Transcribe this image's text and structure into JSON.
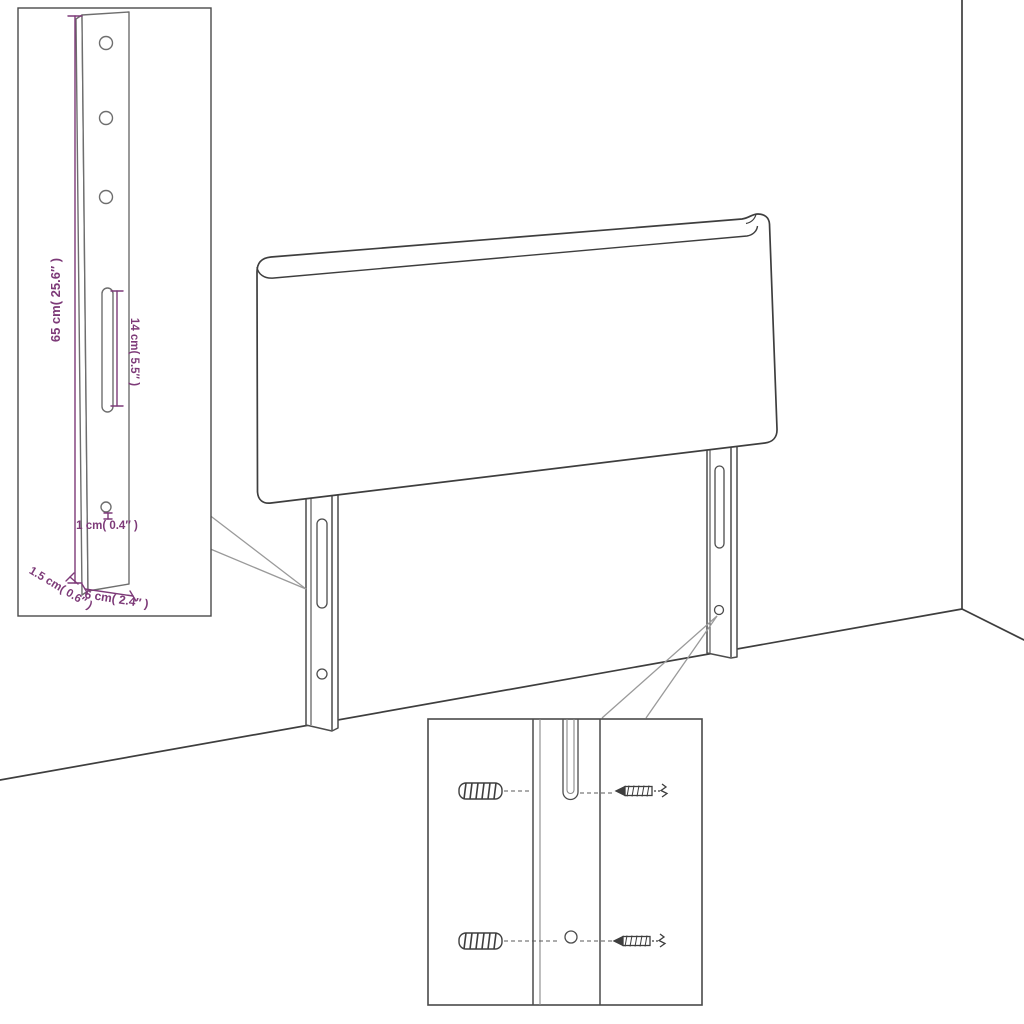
{
  "canvas": {
    "width": 1024,
    "height": 1024,
    "background": "#ffffff"
  },
  "palette": {
    "line": "#3e3e3e",
    "part_line": "#4c4c4c",
    "leader_line": "#9a9a9a",
    "annotation": "#7d3a78",
    "inset_border": "#4a4a4a",
    "fill": "#ffffff"
  },
  "scene": {
    "subject": "Headboard with two slotted wall-mount legs shown in a room corner, with a leg-dimension inset and a mounting-hardware inset",
    "insets": {
      "leg_dimensions": {
        "height_label": "65 cm( 25.6″ )",
        "slot_label": "14 cm( 5.5″ )",
        "hole_label": "1 cm( 0.4″ )",
        "depth_label": "1.5 cm( 0.6″ )",
        "width_label": "6 cm( 2.4″ )"
      },
      "mounting_hardware": {
        "parts": [
          "wall anchor",
          "screw",
          "leg slot",
          "leg hole"
        ]
      }
    }
  }
}
